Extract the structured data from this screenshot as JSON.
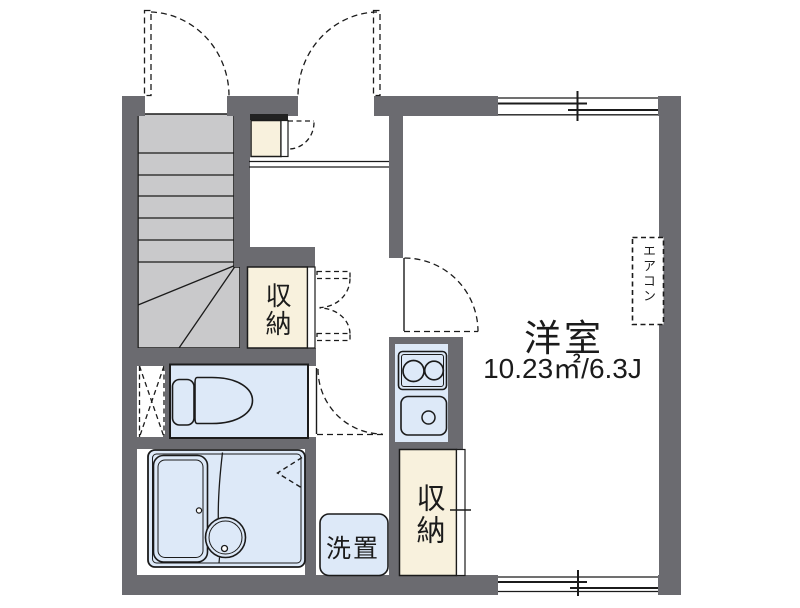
{
  "labels": {
    "main_room": "洋室",
    "main_room_area": "10.23㎡/6.3J",
    "storage_hall": "収納",
    "storage_main": "収納",
    "washer_space": "洗置",
    "aircon": "エアコン"
  },
  "colors": {
    "wall": "#6b6b70",
    "stairs": "#c9c9cb",
    "storage_fill": "#f8f1dd",
    "water_fill": "#dde9f8",
    "line": "#1b1b1b",
    "background": "#ffffff"
  }
}
